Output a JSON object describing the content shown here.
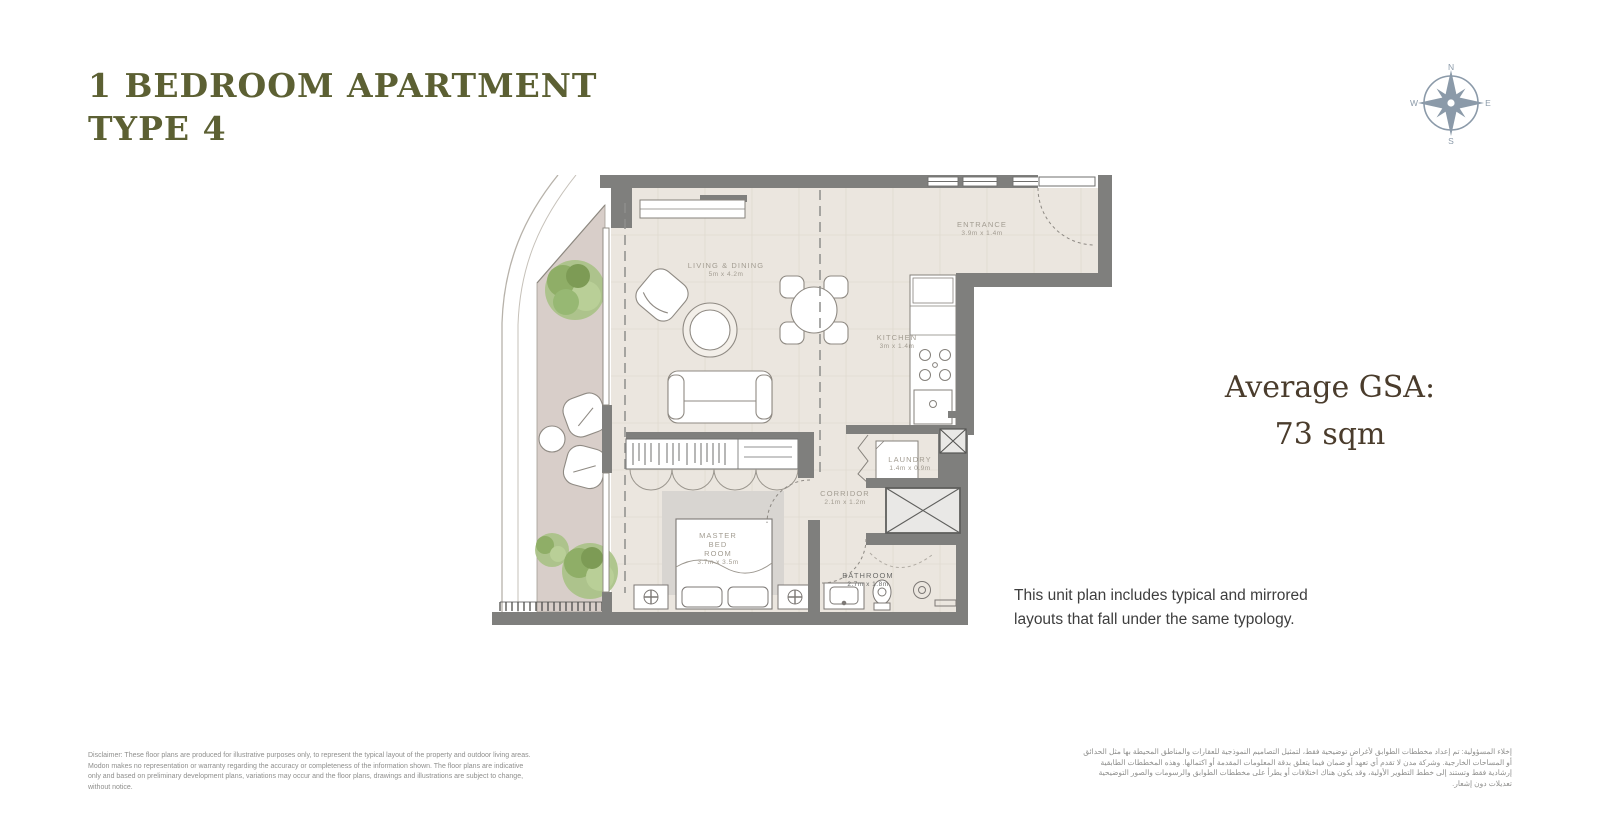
{
  "header": {
    "title_line1": "1 BEDROOM APARTMENT",
    "title_line2": "TYPE 4",
    "color": "#5c6033"
  },
  "compass": {
    "n": "N",
    "e": "E",
    "s": "S",
    "w": "W",
    "color": "#8b9aa9"
  },
  "gsa": {
    "label": "Average GSA:",
    "value": "73 sqm",
    "color": "#4a3c2c"
  },
  "note": {
    "line1": "This unit plan includes typical and mirrored",
    "line2": "layouts that fall under the same typology."
  },
  "plan": {
    "rooms": [
      {
        "name": "LIVING & DINING",
        "dims": "5m x 4.2m"
      },
      {
        "name": "ENTRANCE",
        "dims": "3.9m x 1.4m"
      },
      {
        "name": "KITCHEN",
        "dims": "3m x 1.4m"
      },
      {
        "name": "LAUNDRY",
        "dims": "1.4m x 0.9m"
      },
      {
        "name": "CORRIDOR",
        "dims": "2.1m x 1.2m"
      },
      {
        "name": "MASTER BED ROOM",
        "dims": "3.7m x 3.5m"
      },
      {
        "name": "BATHROOM",
        "dims": "2.7m x 1.8m"
      }
    ],
    "colors": {
      "wall": "#7f7f7d",
      "floor": "#ebe6df",
      "balcony": "#d8cec9",
      "shaft": "#e9e8e6",
      "rug": "#d8d5d1",
      "tree_green": "#a8c285"
    }
  },
  "footer": {
    "disclaimer_en": "Disclaimer: These floor plans are produced for illustrative purposes only, to represent the typical layout of the property and outdoor living areas.  Modon makes no representation or warranty regarding the accuracy or completeness of the information shown.  The floor plans are indicative only and based on preliminary development plans, variations may occur and the floor plans, drawings and illustrations are subject to change, without notice.",
    "disclaimer_ar": "إخلاء المسؤولية: تم إعداد مخططات الطوابق لأغراض توضيحية فقط، لتمثيل التصاميم النموذجية للعقارات والمناطق المحيطة بها مثل الحدائق أو المساحات الخارجية. وشركة مدن لا تقدم أي تعهد أو ضمان فيما يتعلق بدقة المعلومات المقدمة أو اكتمالها. وهذه المخططات الطابقية إرشادية فقط وتستند إلى خطط التطوير الأولية، وقد يكون هناك اختلافات أو يطرأ على مخططات الطوابق والرسومات والصور التوضيحية تعديلات دون إشعار."
  }
}
